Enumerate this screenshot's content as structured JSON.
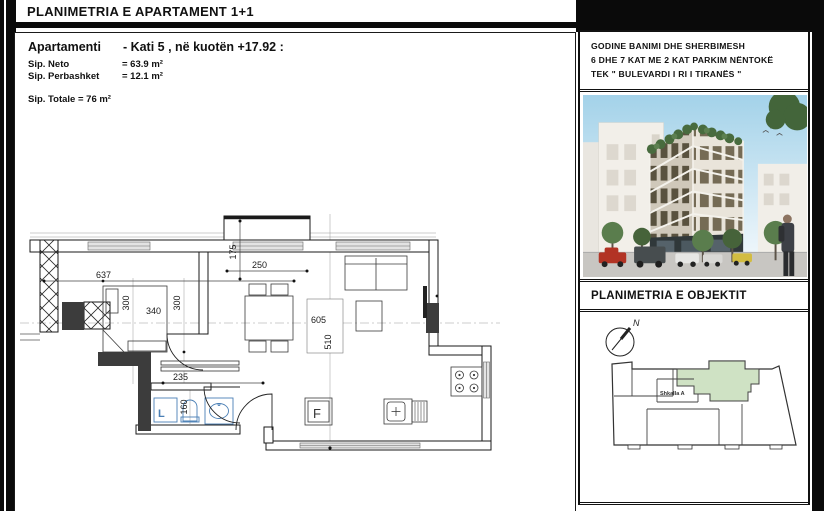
{
  "sheet": {
    "title": "PLANIMETRIA E APARTAMENT 1+1"
  },
  "apartment": {
    "name_label": "Apartamenti",
    "location": "- Kati 5 , në kuotën +17.92 :",
    "net_label": "Sip. Neto",
    "net_value": "= 63.9 m²",
    "shared_label": "Sip. Perbashket",
    "shared_value": "= 12.1  m²",
    "total": "Sip. Totale = 76 m²"
  },
  "project": {
    "line1": "GODINE BANIMI DHE SHERBIMESH",
    "line2": "6 DHE 7 KAT ME 2 KAT PARKIM NËNTOKË",
    "line3": "TEK  \" BULEVARDI I RI I TIRANËS \""
  },
  "site": {
    "title": "PLANIMETRIA E OBJEKTIT",
    "north": "N",
    "stair": "Shkalla A"
  },
  "plan": {
    "dim_total_width": "637",
    "dim_room_a": "300",
    "dim_bed": "340",
    "dim_room_b": "300",
    "dim_balcony_depth": "175",
    "dim_balcony_width": "250",
    "dim_living_width": "605",
    "dim_living_depth": "510",
    "dim_hall": "235",
    "dim_bath": "160",
    "fridge": "F",
    "washer": "L"
  },
  "colors": {
    "unit_highlight": "#cfe2c4",
    "fixture_blue": "#4a7fb5",
    "wall_dark": "#3c3c3c",
    "border_black": "#0a0a0a"
  }
}
